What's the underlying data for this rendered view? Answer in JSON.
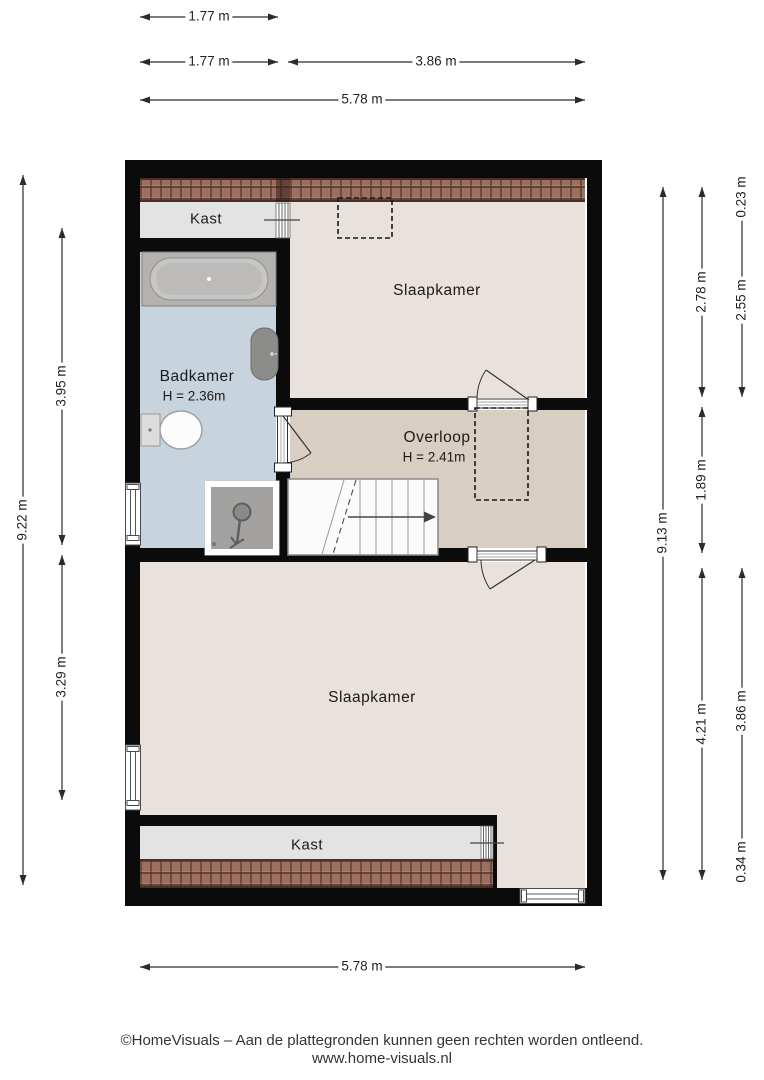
{
  "rooms": {
    "kast_top": {
      "label": "Kast"
    },
    "slaapkamer_top": {
      "label": "Slaapkamer"
    },
    "badkamer": {
      "label": "Badkamer",
      "height": "H = 2.36m"
    },
    "overloop": {
      "label": "Overloop",
      "height": "H = 2.41m"
    },
    "slaapkamer_bottom": {
      "label": "Slaapkamer"
    },
    "kast_bottom": {
      "label": "Kast"
    }
  },
  "dimensions": {
    "top": {
      "row1": "1.77 m",
      "row2_left": "1.77 m",
      "row2_right": "3.86 m",
      "row3": "5.78 m"
    },
    "bottom": {
      "total": "5.78 m"
    },
    "left": {
      "total": "9.22 m",
      "upper": "3.95 m",
      "lower": "3.29 m"
    },
    "right": {
      "total": "9.13 m",
      "col2_top": "2.78 m",
      "col2_mid": "1.89 m",
      "col2_bottom": "4.21 m",
      "col3_roof_top": "0.23 m",
      "col3_top": "2.55 m",
      "col3_bottom": "3.86 m",
      "col3_roof_bottom": "0.34 m"
    }
  },
  "footer": {
    "line1": "©HomeVisuals – Aan de plattegronden kunnen geen rechten worden ontleend.",
    "line2": "www.home-visuals.nl"
  },
  "colors": {
    "wall": "#0b0b0b",
    "floor_bedroom": "#e8e1dc",
    "floor_overloop": "#d8cec2",
    "floor_bathroom": "#c7d4de",
    "floor_closet": "#e3e3e3",
    "roof_tiles": "#9b7061"
  }
}
